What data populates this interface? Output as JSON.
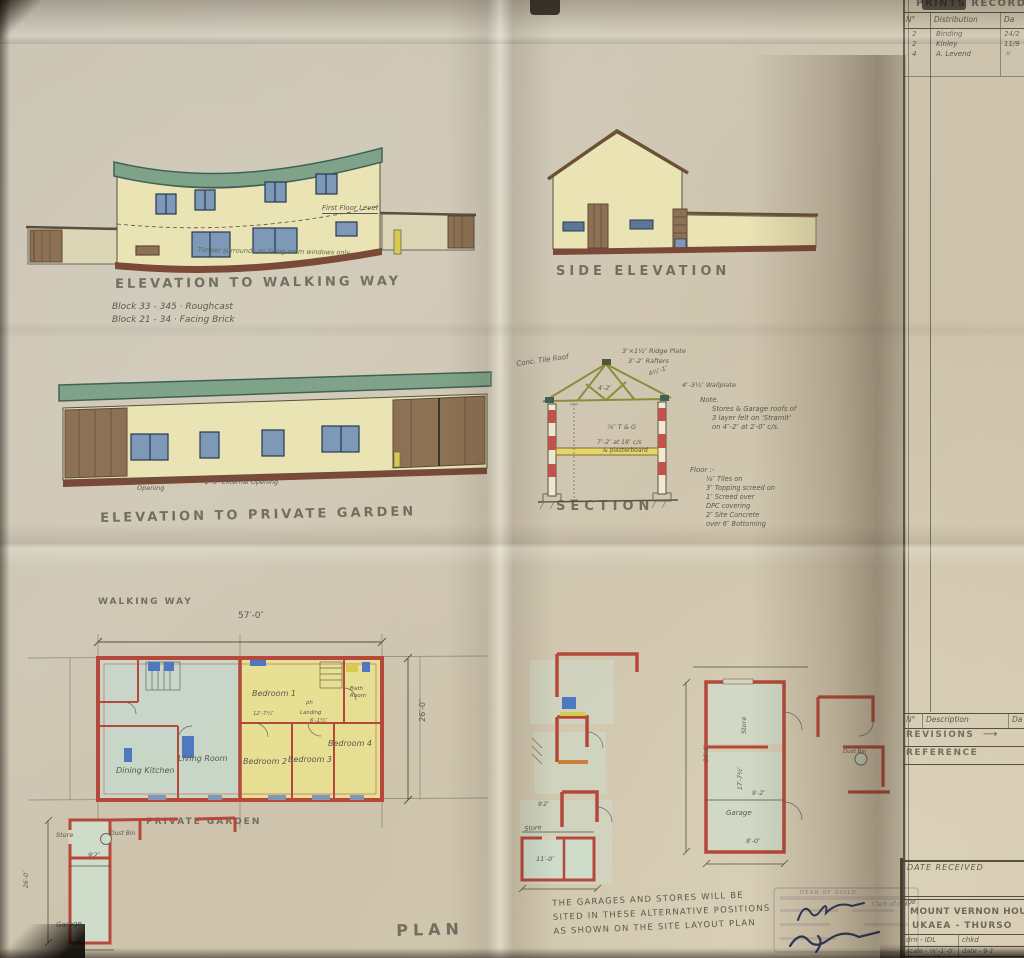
{
  "colors": {
    "paper": "#cdc4b2",
    "roof_green": "#7fa389",
    "wall_cream": "#eae3b4",
    "window_blue": "#7e98b8",
    "plan_wall_red": "#b5483a",
    "floor_green": "#c5d8cb",
    "floor_yellow": "#e9e18f",
    "door_brown": "#8d7154",
    "pencil": "#5a594e",
    "ink": "#26355c"
  },
  "prints_record": {
    "title": "PRINTS RECORD",
    "col_no": "N°",
    "col_dist": "Distribution",
    "col_date": "Da",
    "rows": [
      {
        "no": "2",
        "name": "Binding",
        "date": "24/2"
      },
      {
        "no": "2",
        "name": "Kinley",
        "date": "11/9"
      },
      {
        "no": "4",
        "name": "A. Levend",
        "date": "〃"
      }
    ]
  },
  "revisions": {
    "col_no": "N°",
    "col_desc": "Description",
    "col_date": "Da",
    "title": "REVISIONS",
    "arrow": "⟶",
    "reference": "REFERENCE"
  },
  "title_block": {
    "date_received": "DATE RECEIVED",
    "job_label": "JOB",
    "job1": "MOUNT VERNON HOUS",
    "job2": "UKAEA - THURSO",
    "drn": "drn - IDL",
    "chkd": "chkd",
    "scale": "scale - ⅛″-1′-0″",
    "date": "date - 9-1",
    "drawing_title": "drawing title"
  },
  "stamp": {
    "dean": "DEAN OF GUILD",
    "clerk": "Clerk of Cour"
  },
  "elev_walk": {
    "title": "ELEVATION TO WALKING WAY",
    "block1": "Block 33 - 345 · Roughcast",
    "block2": "Block 21 - 34 · Facing Brick",
    "first_floor": "First Floor Level",
    "timber": "Timber surrounds on living room windows only"
  },
  "elev_side": {
    "title": "SIDE ELEVATION"
  },
  "elev_garden": {
    "title": "ELEVATION TO PRIVATE GARDEN",
    "open1a": "8′0″ External",
    "open1b": "Opening",
    "open2": "2′-3″ External Opening"
  },
  "section": {
    "title": "SECTION",
    "roof": "Conc. Tile Roof",
    "ridge": "3″×1½″ Ridge Plate",
    "rafters": "3″-2″ Rafters",
    "strut": "4½″-1″",
    "tie": "4′-2″",
    "wallplate": "4″-3¼″ Wallplate",
    "tg": "⅞″ T & G",
    "joists1": "7″-2″ at 18″ c/s",
    "joists2": "& plasterboard",
    "note_label": "Note.",
    "note1": "Stores & Garage roofs of",
    "note2": "3 layer felt on ‘Stramit’",
    "note3": "on 4″-2″ at 2′-0″ c/s.",
    "floor_label": "Floor :-",
    "floor1": "⅛″ Tiles on",
    "floor2": "3″ Topping screed on",
    "floor3": "1″ Screed over",
    "floor4": "DPC covering",
    "floor5": "2″ Site Concrete",
    "floor6": "over 6″ Bottoming"
  },
  "plan": {
    "walking_way": "WALKING WAY",
    "dim_w": "57′-0″",
    "dim_d": "26′-0″",
    "d1": "12′-7½″",
    "d2": "6′-1½″",
    "bed1": "Bedroom 1",
    "bed2": "Bedroom 2",
    "bed3": "Bedroom 3",
    "bed4": "Bedroom 4",
    "bath1": "Bath",
    "bath2": "Room",
    "landing": "Landing",
    "ph": "ph",
    "living": "Living Room",
    "dining": "Dining Kitchen",
    "private_garden": "PRIVATE GARDEN",
    "title": "PLAN"
  },
  "store_plan": {
    "store": "Store",
    "dustbin": "Dust Bin",
    "dim_w": "9′2″",
    "dim_h": "26′-0″",
    "garage": "Garage"
  },
  "alt_left": {
    "store": "Store",
    "dim1": "9′2″",
    "dim2": "11′-0″"
  },
  "alt_right": {
    "store": "Store",
    "garage": "Garage",
    "dim_h": "26′-0″",
    "dim_i": "17′-7½″",
    "dim_w": "9′-2″",
    "dim_b": "8′-0″",
    "dustbin": "Dust Bin"
  },
  "note": {
    "l1": "THE GARAGES AND STORES WILL BE",
    "l2": "SITED IN THESE ALTERNATIVE POSITIONS",
    "l3": "AS SHOWN ON THE SITE LAYOUT PLAN"
  }
}
